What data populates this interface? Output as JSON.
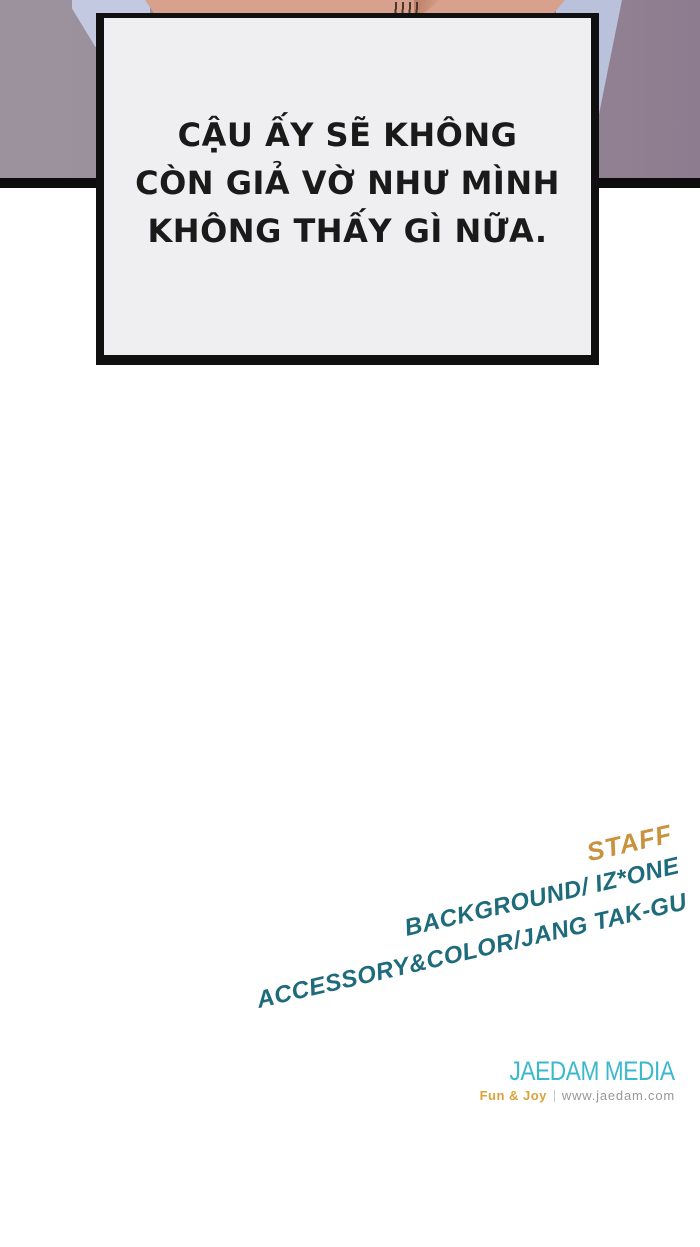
{
  "page": {
    "background_color": "#ffffff"
  },
  "panel": {
    "background_color_left": "#9b929d",
    "background_color_right": "#8d7c8f",
    "clothing_color": "#bfc5dd",
    "skin_color": "#d8a18d",
    "border_color": "#0e0d0e",
    "speech_box": {
      "fill_color": "#efeef0",
      "border_color": "#101010",
      "lines": [
        "CẬU ẤY SẼ KHÔNG",
        "CÒN GIẢ VỜ NHƯ MÌNH",
        "KHÔNG THẤY GÌ NỮA."
      ]
    }
  },
  "credits": {
    "staff_label": "STAFF",
    "staff_color": "#c8923e",
    "text_color": "#1e6b7c",
    "lines": [
      "BACKGROUND/ IZ*ONE",
      "ACCESSORY&COLOR/JANG TAK-GU"
    ]
  },
  "publisher": {
    "name": "JAEDAM MEDIA",
    "name_color": "#3ab9cd",
    "tagline": "Fun & Joy",
    "tagline_color": "#d9a33c",
    "website": "www.jaedam.com",
    "website_color": "#96989a"
  }
}
